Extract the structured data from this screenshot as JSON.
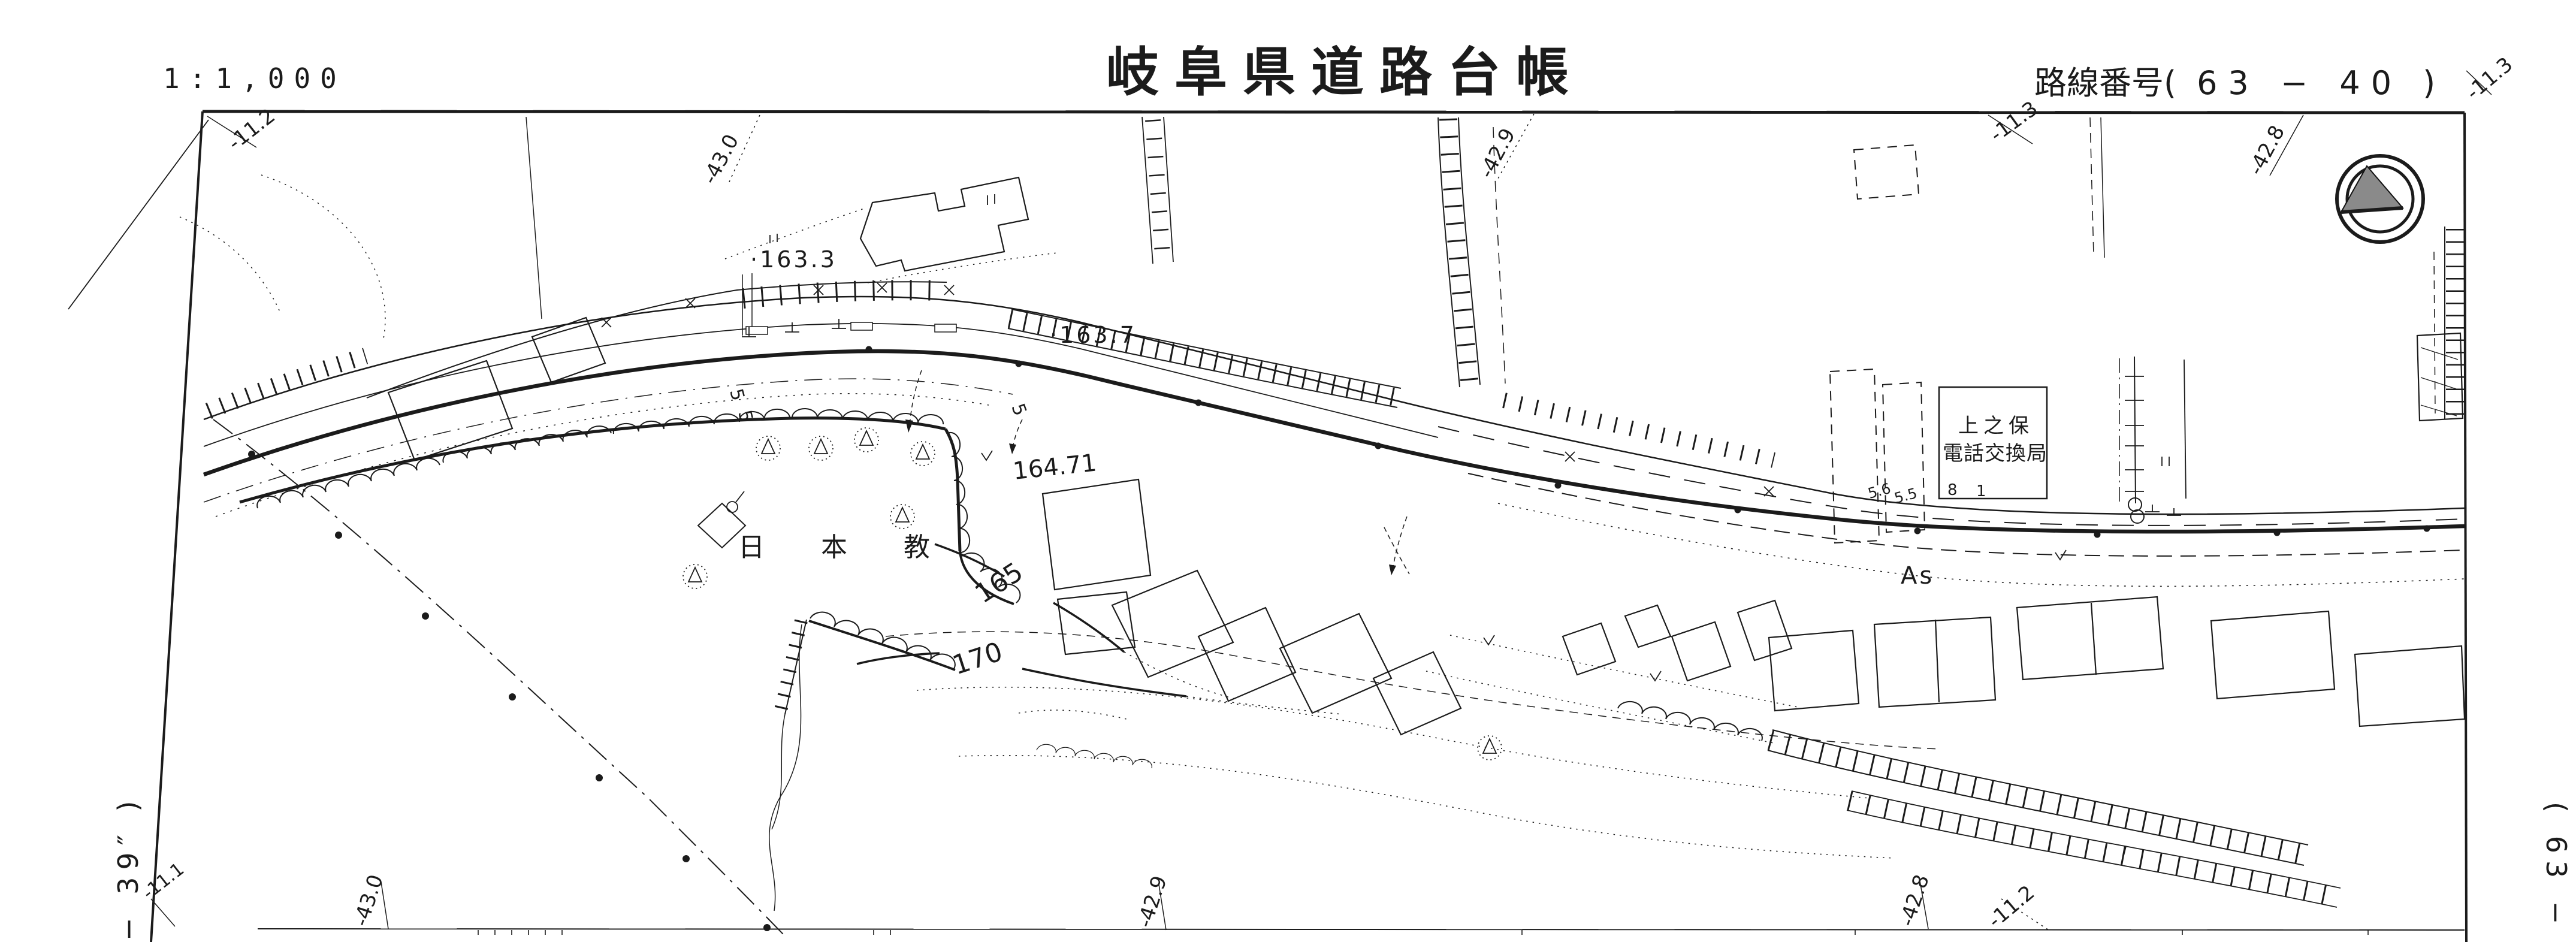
{
  "header": {
    "scale": "1:1,000",
    "title": "岐阜県道路台帳",
    "route_label": "路線番号(",
    "route_number": "63 − 40",
    "route_close": ")"
  },
  "sheet_refs": {
    "left": "− 39″  )",
    "right": "(  63 −"
  },
  "compass_icon": "north-arrow",
  "coord_labels": [
    {
      "text": "-11.2"
    },
    {
      "text": "-43.0"
    },
    {
      "text": "-42.9"
    },
    {
      "text": "-11.3"
    },
    {
      "text": "-42.8"
    },
    {
      "text": "-11.3"
    },
    {
      "text": "-11.1"
    },
    {
      "text": "-43.0"
    },
    {
      "text": "-42.9"
    },
    {
      "text": "-42.8"
    },
    {
      "text": "-11.2"
    }
  ],
  "map_labels": {
    "spot_163_3": "·163.3",
    "spot_163_7": "·163.7",
    "spot_164_71": "164.71",
    "contour_165": "165",
    "contour_170": "170",
    "nihonkyo": "日 本 教",
    "exchange_line1": "上之保",
    "exchange_line2": "電話交換局",
    "surface": "As",
    "w_5_6": "5.6",
    "w_5_5": "5.5",
    "n_8": "8",
    "n_1": "1",
    "w5a": "5",
    "w5b": "5",
    "w5c": "5"
  }
}
